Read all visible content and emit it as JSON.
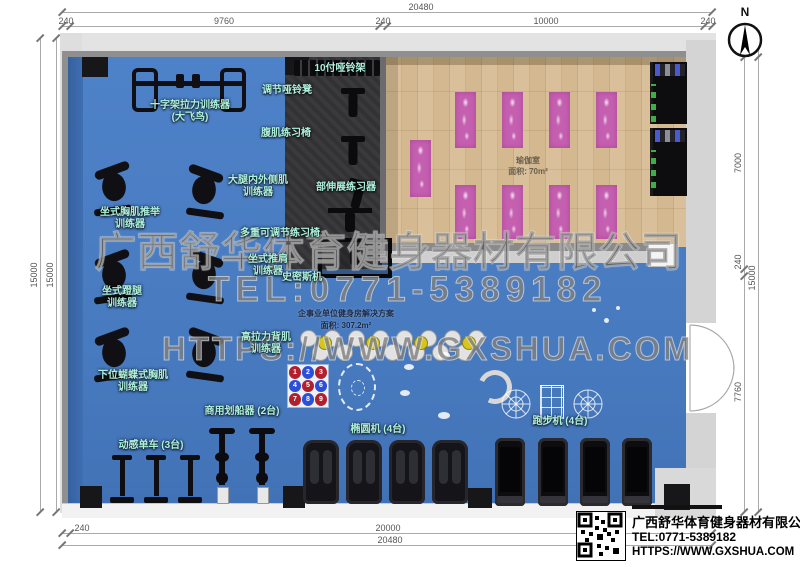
{
  "compass": {
    "label": "N"
  },
  "dims": {
    "top": {
      "overall": "20480",
      "segs": [
        "240",
        "9760",
        "240",
        "10000",
        "240"
      ]
    },
    "bottom": {
      "segs": [
        "240",
        "20000"
      ],
      "overall": "20480"
    },
    "left": {
      "outer": "15000",
      "inner": "15000"
    },
    "right": {
      "segs": [
        "7000",
        "240",
        "7760"
      ],
      "overall": "15000"
    }
  },
  "watermark": {
    "company": "广西舒华体育健身器材有限公司",
    "tel": "TEL:0771-5389182",
    "url": "HTTPS://WWW.GXSHUA.COM"
  },
  "plan": {
    "solution": {
      "title": "企事业单位健身房解决方案",
      "area": "面积: 307.2m²"
    },
    "yoga": {
      "name": "瑜伽室",
      "area": "面积: 70m²"
    },
    "labels": [
      {
        "id": "dumbbell-rack",
        "text": "10付哑铃架"
      },
      {
        "id": "adjustable-dumbbell-bench",
        "text": "调节哑铃凳"
      },
      {
        "id": "cross-cable-trainer",
        "text": "十字架拉力训练器\n(大飞鸟)"
      },
      {
        "id": "ab-exercise-chair",
        "text": "腹肌练习椅"
      },
      {
        "id": "thigh-abductor-trainer",
        "text": "大腿内外侧肌\n训练器"
      },
      {
        "id": "back-stretch-trainer",
        "text": "部伸展练习器"
      },
      {
        "id": "seated-chest-press",
        "text": "坐式胸肌推举\n训练器"
      },
      {
        "id": "multi-adjustable-bench",
        "text": "多重可调节练习椅"
      },
      {
        "id": "seated-shoulder-press",
        "text": "坐式推肩\n训练器"
      },
      {
        "id": "smith-machine",
        "text": "史密斯机"
      },
      {
        "id": "seated-leg-press",
        "text": "坐式蹬腿\n训练器"
      },
      {
        "id": "lat-pulldown",
        "text": "高拉力背肌\n训练器"
      },
      {
        "id": "pec-fly-trainer",
        "text": "下位蝴蝶式胸肌\n训练器"
      },
      {
        "id": "rowing-machines",
        "text": "商用划船器 (2台)"
      },
      {
        "id": "spin-bikes",
        "text": "动感单车 (3台)"
      },
      {
        "id": "ellipticals",
        "text": "椭圆机 (4台)"
      },
      {
        "id": "treadmills",
        "text": "跑步机 (4台)"
      }
    ],
    "number_grid": {
      "cells": [
        {
          "n": "1",
          "color": "red"
        },
        {
          "n": "2",
          "color": "blue"
        },
        {
          "n": "3",
          "color": "red"
        },
        {
          "n": "4",
          "color": "blue"
        },
        {
          "n": "5",
          "color": "red"
        },
        {
          "n": "6",
          "color": "blue"
        },
        {
          "n": "7",
          "color": "red"
        },
        {
          "n": "8",
          "color": "blue"
        },
        {
          "n": "9",
          "color": "red"
        }
      ]
    }
  },
  "info_card": {
    "company": "广西舒华体育健身器材有限公司",
    "tel": "TEL:0771-5389182",
    "url": "HTTPS://WWW.GXSHUA.COM"
  },
  "colors": {
    "floor_blue": "#4a7dc2",
    "floor_wood": "#d7bd95",
    "mat_pink": "#c55fb0",
    "label_cyan": "#aff2dc"
  }
}
